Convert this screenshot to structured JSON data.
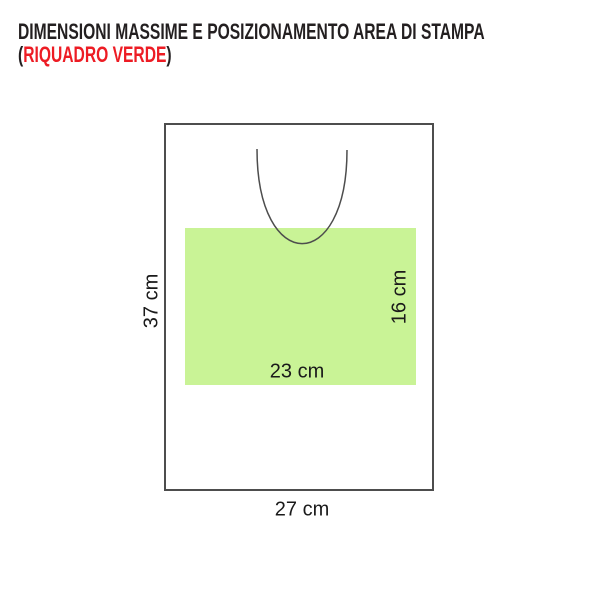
{
  "title": {
    "line1": "DIMENSIONI MASSIME E POSIZIONAMENTO AREA DI STAMPA",
    "line2_prefix": "(",
    "line2_highlight": "RIQUADRO VERDE",
    "line2_suffix": ")"
  },
  "diagram": {
    "bag_height_label": "37 cm",
    "bag_width_label": "27 cm",
    "print_area_width_label": "23 cm",
    "print_area_height_label": "16 cm"
  },
  "colors": {
    "title_text": "#231f20",
    "highlight_red": "#ed1c24",
    "print_area_green": "#c9f396",
    "outline_gray": "#4d4d4d",
    "label_text": "#1a1a1a"
  }
}
